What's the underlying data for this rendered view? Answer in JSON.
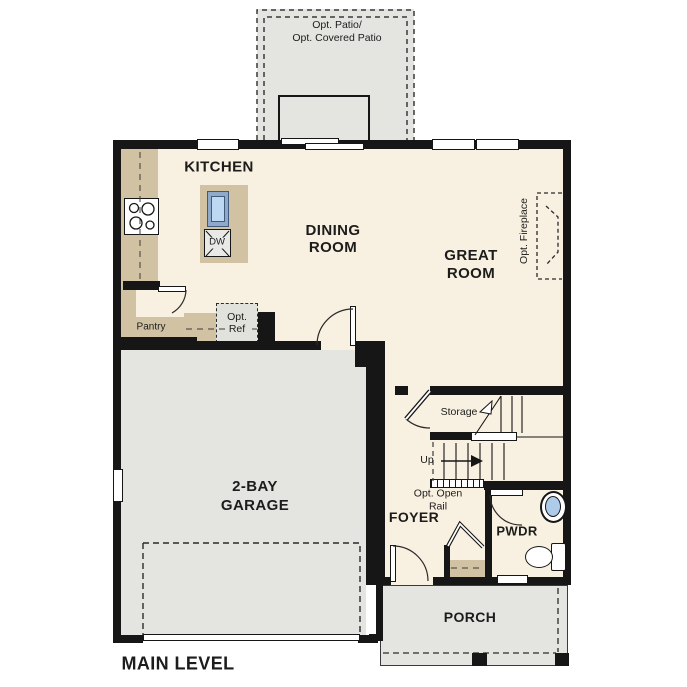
{
  "title": "MAIN LEVEL",
  "rooms": {
    "kitchen": {
      "label": "KITCHEN"
    },
    "dining": {
      "label": "DINING\nROOM"
    },
    "great": {
      "label": "GREAT\nROOM"
    },
    "garage": {
      "label": "2-BAY\nGARAGE"
    },
    "foyer": {
      "label": "FOYER"
    },
    "pwdr": {
      "label": "PWDR"
    },
    "porch": {
      "label": "PORCH"
    },
    "pantry": {
      "label": "Pantry"
    },
    "storage": {
      "label": "Storage"
    }
  },
  "annotations": {
    "patio": "Opt. Patio/\nOpt. Covered Patio",
    "fireplace": "Opt. Fireplace",
    "opt_ref": "Opt.\nRef",
    "up": "Up",
    "open_rail": "Opt. Open\nRail",
    "dishwasher": "DW"
  },
  "colors": {
    "floor": "#f8f0e0",
    "counter": "#d1c2a3",
    "concrete": "#e4e4e1",
    "wall": "#161616",
    "water": "#aecbea",
    "optional": "#e2e2dd"
  }
}
